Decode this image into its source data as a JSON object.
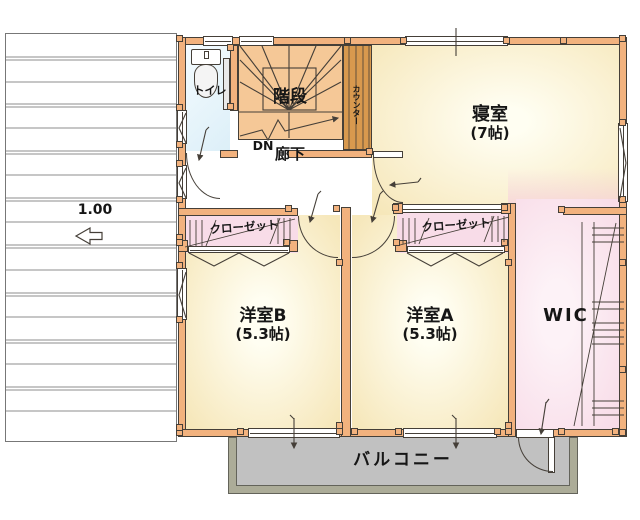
{
  "scale": {
    "label": "1.00"
  },
  "rooms": {
    "toilet": {
      "label": "トイレ"
    },
    "stairs": {
      "label": "階段",
      "direction": "DN"
    },
    "hallway": {
      "label": "廊下"
    },
    "counter": {
      "label": "カウンター"
    },
    "bedroom": {
      "label": "寝室",
      "size": "(7帖)"
    },
    "room_b": {
      "label": "洋室B",
      "size": "(5.3帖)"
    },
    "room_a": {
      "label": "洋室A",
      "size": "(5.3帖)"
    },
    "closet_b": {
      "label": "クローゼット"
    },
    "closet_a": {
      "label": "クローゼット"
    },
    "wic": {
      "label": "WIC"
    },
    "balcony": {
      "label": "バルコニー"
    }
  },
  "colors": {
    "wall": "#F2B27E",
    "line": "#453F38",
    "stairs": "#F5C897",
    "counter": "#D8994E",
    "floor_light": "#FFFEF2",
    "floor": "#F6E7BA",
    "toilet_floor": "#DCEFF8",
    "closet_floor": "#F8DCE8",
    "balcony": "#C1C1C1",
    "balcony_edge": "#ACAC98",
    "roof_line": "#8C8C8C"
  }
}
